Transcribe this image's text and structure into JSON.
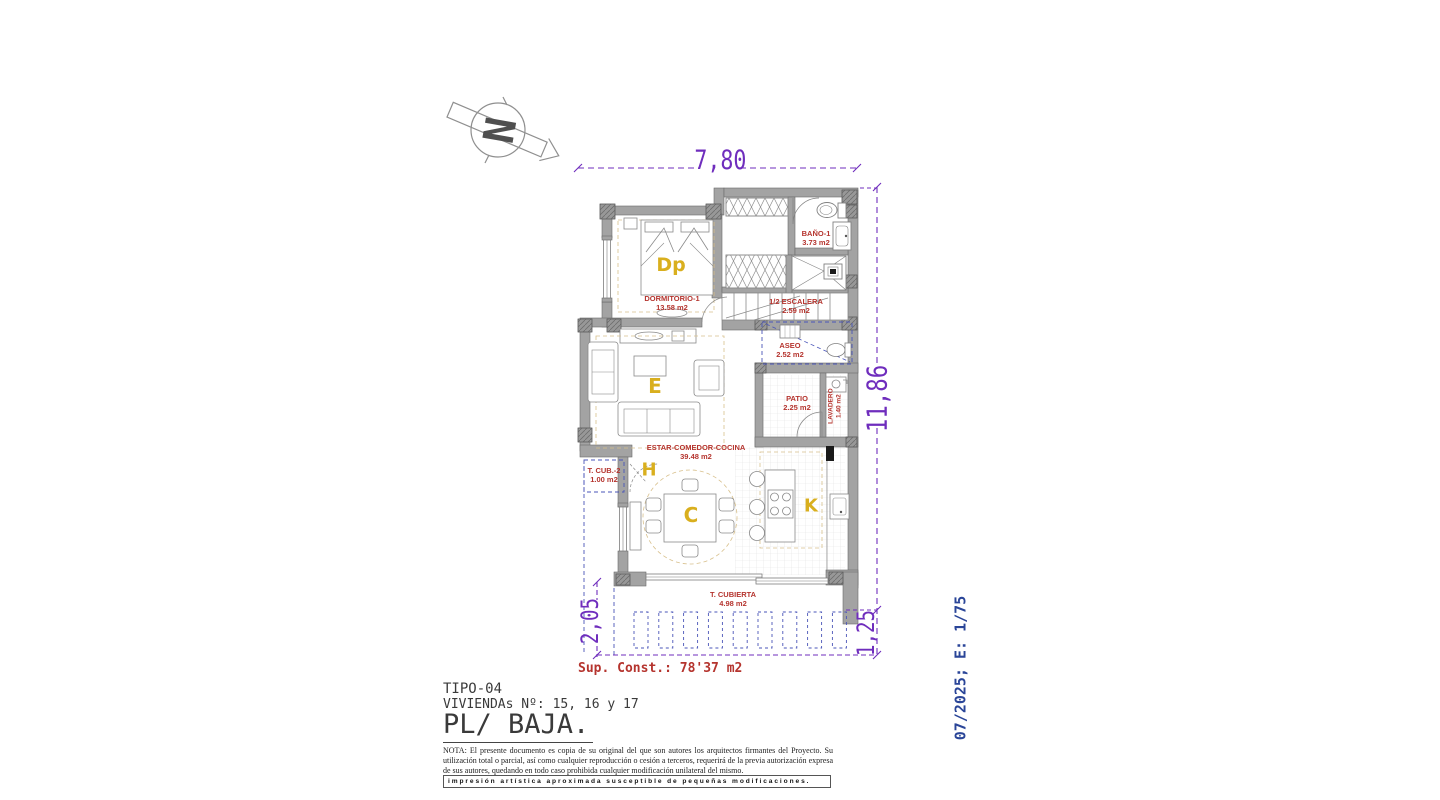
{
  "compass": {
    "label": "N"
  },
  "dimensions": {
    "top": "7,80",
    "right": "11,86",
    "bottom_left": "2,05",
    "bottom_right": "1,25"
  },
  "rooms": {
    "dormitorio": {
      "name": "DORMITORIO-1",
      "area": "13.58 m2",
      "letter": "Dp"
    },
    "bano": {
      "name": "BAÑO-1",
      "area": "3.73 m2"
    },
    "escalera": {
      "name": "1/2 ESCALERA",
      "area": "2.59 m2"
    },
    "aseo": {
      "name": "ASEO",
      "area": "2.52 m2"
    },
    "patio": {
      "name": "PATIO",
      "area": "2.25 m2"
    },
    "lavadero": {
      "name": "LAVADERO",
      "area": "1.40 m2"
    },
    "estar": {
      "name": "ESTAR-COMEDOR-COCINA",
      "area": "39.48 m2",
      "letter_estar": "E",
      "letter_comedor": "C",
      "letter_cocina": "K",
      "letter_hall": "H"
    },
    "tcub2": {
      "name": "T. CUB.-2",
      "area": "1.00 m2"
    },
    "tcubierta": {
      "name": "T. CUBIERTA",
      "area": "4.98 m2"
    }
  },
  "summary": {
    "sup_const": "Sup. Const.: 78'37 m2"
  },
  "title_block": {
    "tipo": "TIPO-04",
    "viviendas": "VIVIENDAs Nº: 15, 16 y 17",
    "planta": "PL/ BAJA."
  },
  "side_note": "07/2025; E: 1/75",
  "legal": {
    "nota": "NOTA: El presente documento es copia de su original del que son autores los arquitectos firmantes del Proyecto. Su utilización total o parcial, así como cualquier reproducción o cesión a terceros, requerirá de la previa autorización expresa de sus autores, quedando en todo caso prohibida cualquier modificación unilateral del mismo.",
    "impresion": "impresión artística aproximada susceptible de pequeñas modificaciones."
  },
  "colors": {
    "label_red": "#b5342e",
    "letter_gold": "#d9af1e",
    "dim_purple": "#6f2dbd",
    "side_blue": "#2a4598",
    "dash_blue": "#4a55b8",
    "wall_gray": "#a3a3a3",
    "dash_tan": "#d8c08c"
  }
}
